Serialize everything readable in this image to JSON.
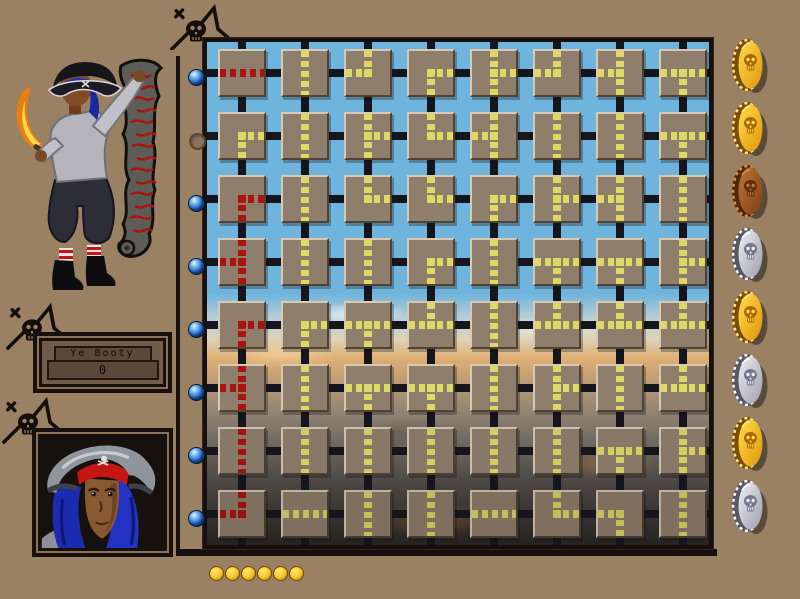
{
  "booty_panel": {
    "label": "Ye Booty",
    "value": "0"
  },
  "board": {
    "rows": 8,
    "cols": 8,
    "tile_encoding": "letters = pipe openings (L left, R right, T top, B bottom); prefix R: = red filled pipe",
    "grid": [
      [
        "R:LR",
        "TB",
        "LT",
        "RB",
        "TBR",
        "LT",
        "TBL",
        "LRB"
      ],
      [
        "RB",
        "TB",
        "TBR",
        "TR",
        "TBL",
        "TB",
        "TB",
        "LRB"
      ],
      [
        "R:RB",
        "TB",
        "TR",
        "TR",
        "RB",
        "TBR",
        "TBL",
        "TB"
      ],
      [
        "R:TBL",
        "TB",
        "TB",
        "RB",
        "TB",
        "LRB",
        "LRB",
        "TBR"
      ],
      [
        "R:RB",
        "RB",
        "LRB",
        "LRT",
        "TB",
        "LRT",
        "LRT",
        "LRT"
      ],
      [
        "R:TBL",
        "TB",
        "LRB",
        "LRB",
        "TB",
        "TBR",
        "TB",
        "LRT"
      ],
      [
        "R:TB",
        "TB",
        "TB",
        "TB",
        "TB",
        "TB",
        "LRB",
        "TBR"
      ],
      [
        "R:LT",
        "LR",
        "TB",
        "TB",
        "LR",
        "TR",
        "LB",
        "TB"
      ]
    ]
  },
  "row_markers": [
    "on",
    "off",
    "on",
    "on",
    "on",
    "on",
    "on",
    "on"
  ],
  "treasure_coins": [
    "gold",
    "gold",
    "bronze",
    "silver",
    "gold",
    "silver",
    "gold",
    "silver"
  ],
  "progress_coins": {
    "count": 6,
    "metal": "gold"
  },
  "icons": [
    "skull-crossbones-icon",
    "skull-coin-icon"
  ],
  "colors": {
    "page_bg": "#9a8164",
    "sky": "#6fb4dd",
    "tile": "#8f7e6c",
    "pipe_yellow": "#ded964",
    "pipe_red": "#aa1410",
    "lattice": "#15151d",
    "frame": "#17100e",
    "marker_blue": "#1f6fd0",
    "coin": {
      "gold": {
        "edge": "#7a4c04",
        "ridge": "#ffe690",
        "face1": "#ffdf45",
        "face2": "#e0930e",
        "skull": "#a86808"
      },
      "bronze": {
        "edge": "#4e2810",
        "ridge": "#d89050",
        "face1": "#c07434",
        "face2": "#7e3f14",
        "skull": "#5e2e10"
      },
      "silver": {
        "edge": "#585864",
        "ridge": "#ffffff",
        "face1": "#eeeef4",
        "face2": "#9d9dae",
        "skull": "#77778a"
      }
    }
  }
}
